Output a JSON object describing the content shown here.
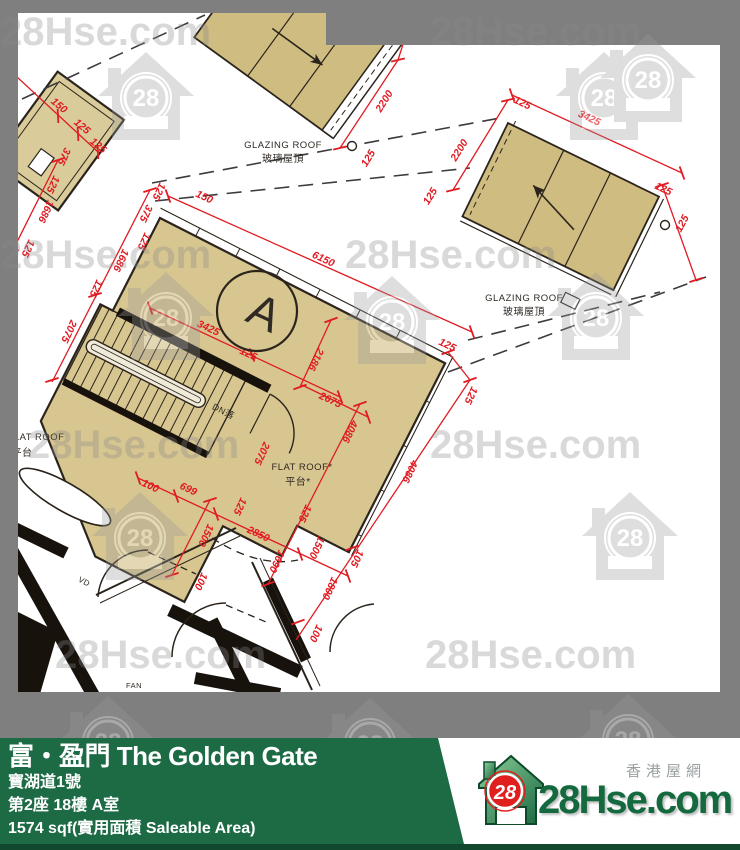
{
  "watermark": {
    "text": "28Hse.com",
    "house_number": "28",
    "text_positions": [
      {
        "x": 0,
        "y": 45
      },
      {
        "x": 430,
        "y": 45
      },
      {
        "x": 0,
        "y": 268
      },
      {
        "x": 345,
        "y": 268
      },
      {
        "x": 28,
        "y": 458
      },
      {
        "x": 430,
        "y": 458
      },
      {
        "x": 55,
        "y": 668
      },
      {
        "x": 425,
        "y": 668
      }
    ],
    "house_positions": [
      {
        "x": 98,
        "y": 52
      },
      {
        "x": 556,
        "y": 52
      },
      {
        "x": 600,
        "y": 34
      },
      {
        "x": 118,
        "y": 272
      },
      {
        "x": 548,
        "y": 272
      },
      {
        "x": 344,
        "y": 276
      },
      {
        "x": 92,
        "y": 492
      },
      {
        "x": 582,
        "y": 492
      },
      {
        "x": 60,
        "y": 696
      },
      {
        "x": 322,
        "y": 698
      },
      {
        "x": 580,
        "y": 694
      }
    ]
  },
  "plan": {
    "colors": {
      "roof_fill": "#cfbc80",
      "unit_fill": "#d7c690",
      "dim_red": "#e01b22",
      "wall_dark": "#2b241c"
    },
    "unit_label": "A",
    "labels": [
      {
        "t": "GLAZING ROOF",
        "x": 283,
        "y": 148,
        "r": 0,
        "s": 9.5
      },
      {
        "t": "玻璃屋頂",
        "x": 283,
        "y": 162,
        "r": 0,
        "s": 10
      },
      {
        "t": "GLAZING ROOF",
        "x": 524,
        "y": 301,
        "r": 0,
        "s": 9.5
      },
      {
        "t": "玻璃屋頂",
        "x": 524,
        "y": 315,
        "r": 0,
        "s": 10
      },
      {
        "t": "FLAT ROOF",
        "x": 36,
        "y": 440,
        "r": 0,
        "s": 9.5
      },
      {
        "t": "平台",
        "x": 22,
        "y": 456,
        "r": 0,
        "s": 10
      },
      {
        "t": "FLAT ROOF*",
        "x": 302,
        "y": 470,
        "r": 0,
        "s": 9.5
      },
      {
        "t": "平台*",
        "x": 298,
        "y": 485,
        "r": 0,
        "s": 10
      },
      {
        "t": "DN落",
        "x": 222,
        "y": 414,
        "r": 27,
        "s": 9
      },
      {
        "t": "A",
        "x": 258,
        "y": 327,
        "r": 25,
        "s": 46
      },
      {
        "t": "VD",
        "x": 83,
        "y": 584,
        "r": 27,
        "s": 8
      },
      {
        "t": "FAN",
        "x": 134,
        "y": 688,
        "r": 0,
        "s": 7.5
      }
    ],
    "dimensions": [
      {
        "t": "6150",
        "x": 322,
        "y": 262,
        "r": 25
      },
      {
        "t": "3425",
        "x": 207,
        "y": 331,
        "r": 25
      },
      {
        "t": "125",
        "x": 247,
        "y": 357,
        "r": 25
      },
      {
        "t": "2186",
        "x": 313,
        "y": 358,
        "r": 115
      },
      {
        "t": "2675",
        "x": 329,
        "y": 403,
        "r": 25
      },
      {
        "t": "4086",
        "x": 347,
        "y": 430,
        "r": 115
      },
      {
        "t": "4086",
        "x": 407,
        "y": 470,
        "r": 115
      },
      {
        "t": "125",
        "x": 446,
        "y": 348,
        "r": 25
      },
      {
        "t": "125",
        "x": 468,
        "y": 394,
        "r": 115
      },
      {
        "t": "105",
        "x": 354,
        "y": 557,
        "r": 115
      },
      {
        "t": "1800",
        "x": 327,
        "y": 587,
        "r": 115
      },
      {
        "t": "100",
        "x": 313,
        "y": 632,
        "r": 115
      },
      {
        "t": "2075",
        "x": 66,
        "y": 330,
        "r": 115
      },
      {
        "t": "2075",
        "x": 259,
        "y": 452,
        "r": 115
      },
      {
        "t": "1686",
        "x": 43,
        "y": 210,
        "r": 115
      },
      {
        "t": "1686",
        "x": 118,
        "y": 259,
        "r": 115
      },
      {
        "t": "125",
        "x": 25,
        "y": 247,
        "r": 115
      },
      {
        "t": "125",
        "x": 93,
        "y": 287,
        "r": 115
      },
      {
        "t": "125",
        "x": 141,
        "y": 240,
        "r": 115
      },
      {
        "t": "375",
        "x": 143,
        "y": 212,
        "r": 115
      },
      {
        "t": "125",
        "x": 156,
        "y": 190,
        "r": 115
      },
      {
        "t": "150",
        "x": 203,
        "y": 200,
        "r": 25
      },
      {
        "t": "2200",
        "x": 387,
        "y": 103,
        "r": -58
      },
      {
        "t": "125",
        "x": 371,
        "y": 160,
        "r": -58
      },
      {
        "t": "2200",
        "x": 462,
        "y": 152,
        "r": -58
      },
      {
        "t": "125",
        "x": 433,
        "y": 198,
        "r": -58
      },
      {
        "t": "125",
        "x": 521,
        "y": 106,
        "r": 25
      },
      {
        "t": "3425",
        "x": 588,
        "y": 121,
        "r": 25
      },
      {
        "t": "125",
        "x": 662,
        "y": 192,
        "r": 25
      },
      {
        "t": "125",
        "x": 685,
        "y": 225,
        "r": -62
      },
      {
        "t": "100",
        "x": 149,
        "y": 489,
        "r": 25
      },
      {
        "t": "699",
        "x": 187,
        "y": 492,
        "r": 25
      },
      {
        "t": "2850",
        "x": 257,
        "y": 537,
        "r": 25
      },
      {
        "t": "125",
        "x": 237,
        "y": 505,
        "r": 115
      },
      {
        "t": "1500",
        "x": 314,
        "y": 546,
        "r": 115
      },
      {
        "t": "125",
        "x": 302,
        "y": 512,
        "r": 115
      },
      {
        "t": "1690",
        "x": 274,
        "y": 560,
        "r": 115
      },
      {
        "t": "1500",
        "x": 203,
        "y": 534,
        "r": 115
      },
      {
        "t": "100",
        "x": 198,
        "y": 580,
        "r": 115
      },
      {
        "t": "150",
        "x": 57,
        "y": 108,
        "r": 40
      },
      {
        "t": "125",
        "x": 80,
        "y": 129,
        "r": 40
      },
      {
        "t": "125",
        "x": 96,
        "y": 148,
        "r": 40
      },
      {
        "t": "375",
        "x": 61,
        "y": 155,
        "r": 115
      },
      {
        "t": "125",
        "x": 50,
        "y": 183,
        "r": 115
      }
    ],
    "ticks": [
      {
        "x": 168,
        "y": 196,
        "r": 25
      },
      {
        "x": 472,
        "y": 332,
        "r": 25
      },
      {
        "x": 150,
        "y": 308,
        "r": 25
      },
      {
        "x": 340,
        "y": 397,
        "r": 25
      },
      {
        "x": 252,
        "y": 355,
        "r": 25
      },
      {
        "x": 331,
        "y": 320,
        "r": 115
      },
      {
        "x": 300,
        "y": 387,
        "r": 115
      },
      {
        "x": 368,
        "y": 417,
        "r": 25
      },
      {
        "x": 360,
        "y": 404,
        "r": 115
      },
      {
        "x": 268,
        "y": 584,
        "r": 115
      },
      {
        "x": 470,
        "y": 380,
        "r": 115
      },
      {
        "x": 448,
        "y": 352,
        "r": 115
      },
      {
        "x": 352,
        "y": 548,
        "r": 115
      },
      {
        "x": 298,
        "y": 622,
        "r": 115
      },
      {
        "x": 512,
        "y": 95,
        "r": 25
      },
      {
        "x": 682,
        "y": 173,
        "r": 25
      },
      {
        "x": 508,
        "y": 100,
        "r": 122
      },
      {
        "x": 453,
        "y": 190,
        "r": 122
      },
      {
        "x": 398,
        "y": 60,
        "r": 122
      },
      {
        "x": 340,
        "y": 148,
        "r": 122
      },
      {
        "x": 138,
        "y": 478,
        "r": 25
      },
      {
        "x": 348,
        "y": 576,
        "r": 25
      },
      {
        "x": 176,
        "y": 496,
        "r": 25
      },
      {
        "x": 216,
        "y": 514,
        "r": 25
      },
      {
        "x": 300,
        "y": 554,
        "r": 25
      },
      {
        "x": 210,
        "y": 500,
        "r": 117
      },
      {
        "x": 172,
        "y": 575,
        "r": 117
      },
      {
        "x": 58,
        "y": 160,
        "r": 117
      },
      {
        "x": 12,
        "y": 252,
        "r": 117
      },
      {
        "x": 150,
        "y": 190,
        "r": 117
      },
      {
        "x": 52,
        "y": 380,
        "r": 117
      },
      {
        "x": 95,
        "y": 295,
        "r": 117
      },
      {
        "x": 16,
        "y": 76,
        "r": 42
      },
      {
        "x": 98,
        "y": 152,
        "r": 42
      },
      {
        "x": 58,
        "y": 116,
        "r": 42
      },
      {
        "x": 78,
        "y": 134,
        "r": 42
      },
      {
        "x": 662,
        "y": 185,
        "r": 117
      },
      {
        "x": 696,
        "y": 280,
        "r": 117
      }
    ]
  },
  "footer": {
    "title": "富・盈門 The Golden Gate",
    "address": "寶湖道1號",
    "unit": "第2座 18樓 A室",
    "area": "1574 sqf(實用面積 Saleable Area)",
    "brand": {
      "site_name": "28Hse.com",
      "site_name_cn": "香港屋網",
      "logo_number": "28"
    },
    "colors": {
      "bar_green": "#1c6b45",
      "bar_green_dark": "#12492e"
    }
  }
}
